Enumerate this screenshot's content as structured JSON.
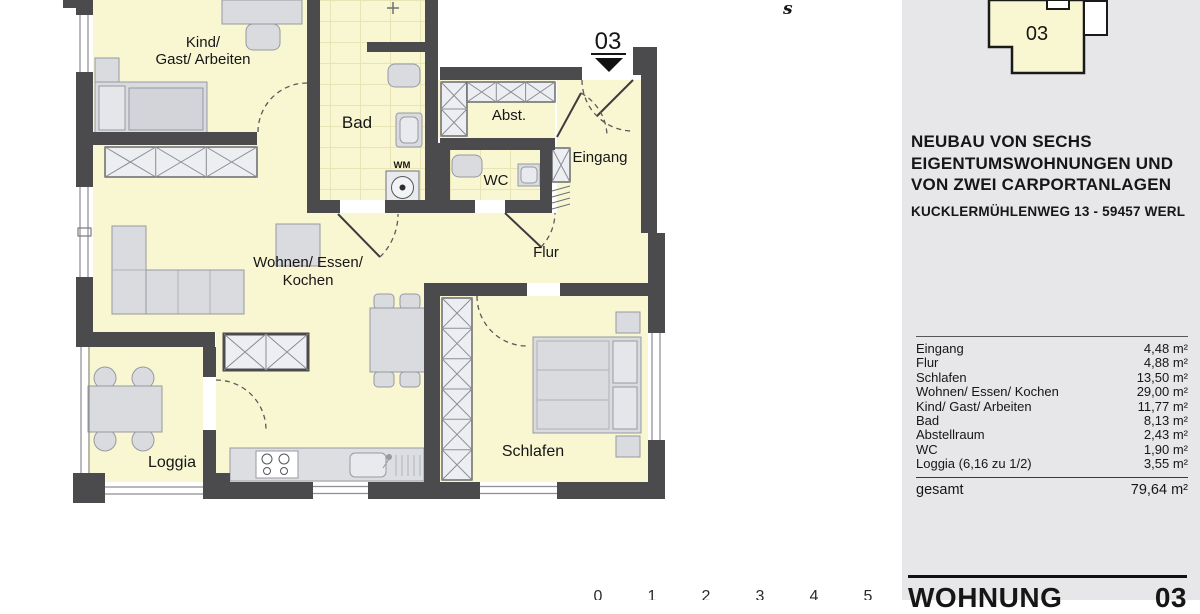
{
  "plan": {
    "rooms": {
      "kind_line1": "Kind/",
      "kind_line2": "Gast/ Arbeiten",
      "bad": "Bad",
      "abst": "Abst.",
      "eingang": "Eingang",
      "wc": "WC",
      "flur": "Flur",
      "wohnen_line1": "Wohnen/ Essen/",
      "wohnen_line2": "Kochen",
      "schlafen": "Schlafen",
      "loggia": "Loggia"
    },
    "labels": {
      "wm": "WM"
    },
    "entrance": {
      "number": "03"
    },
    "compass": {
      "south": "s"
    },
    "scale": {
      "ticks": [
        "0",
        "1",
        "2",
        "3",
        "4",
        "5"
      ]
    }
  },
  "site_plan": {
    "unit": "03"
  },
  "project": {
    "title_line1": "NEUBAU VON SECHS",
    "title_line2": "EIGENTUMSWOHNUNGEN UND",
    "title_line3": "VON ZWEI CARPORTANLAGEN",
    "address": "KUCKLERMÜHLENWEG 13 - 59457 WERL"
  },
  "areas": {
    "rows": [
      {
        "label": "Eingang",
        "value": "4,48 m²"
      },
      {
        "label": "Flur",
        "value": "4,88 m²"
      },
      {
        "label": "Schlafen",
        "value": "13,50 m²"
      },
      {
        "label": "Wohnen/ Essen/ Kochen",
        "value": "29,00 m²"
      },
      {
        "label": "Kind/ Gast/ Arbeiten",
        "value": "11,77 m²"
      },
      {
        "label": "Bad",
        "value": "8,13 m²"
      },
      {
        "label": "Abstellraum",
        "value": "2,43 m²"
      },
      {
        "label": "WC",
        "value": "1,90 m²"
      },
      {
        "label": "Loggia (6,16 zu 1/2)",
        "value": "3,55 m²"
      }
    ],
    "total_label": "gesamt",
    "total_value": "79,64 m²"
  },
  "footer": {
    "label": "WOHNUNG",
    "number": "03"
  },
  "colors": {
    "wall": "#4b4b4d",
    "room_fill": "#f9f7d2",
    "panel_bg": "#e7e7e9",
    "furniture": "#d9dbdf"
  }
}
